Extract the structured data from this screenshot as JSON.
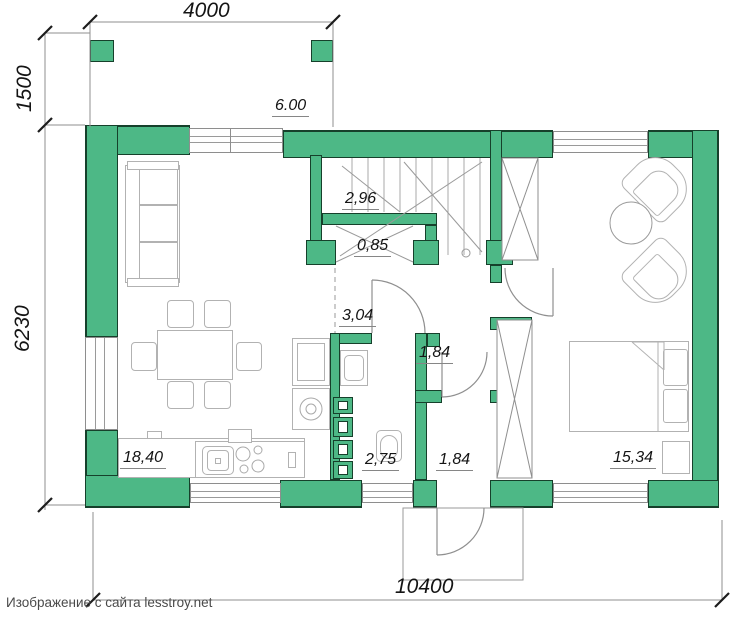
{
  "title": "floor-plan",
  "watermark": "Изображение с сайта lesstroy.net",
  "colors": {
    "wall": "#4db886",
    "edge": "#16402b",
    "furn": "#b2b2b2",
    "dim": "#8f8f8f",
    "text": "#141414"
  },
  "dimensions": {
    "top_width_mm": "4000",
    "porch_depth_mm": "1500",
    "side_height_mm": "6230",
    "bottom_width_mm": "10400"
  },
  "areas": {
    "porch": "6.00",
    "stairs": "2,96",
    "under_stairs": "0,85",
    "hall": "3,04",
    "closet": "1,84",
    "kitchen_living": "18,40",
    "wc": "2,75",
    "corridor": "1,84",
    "room": "15,34"
  }
}
